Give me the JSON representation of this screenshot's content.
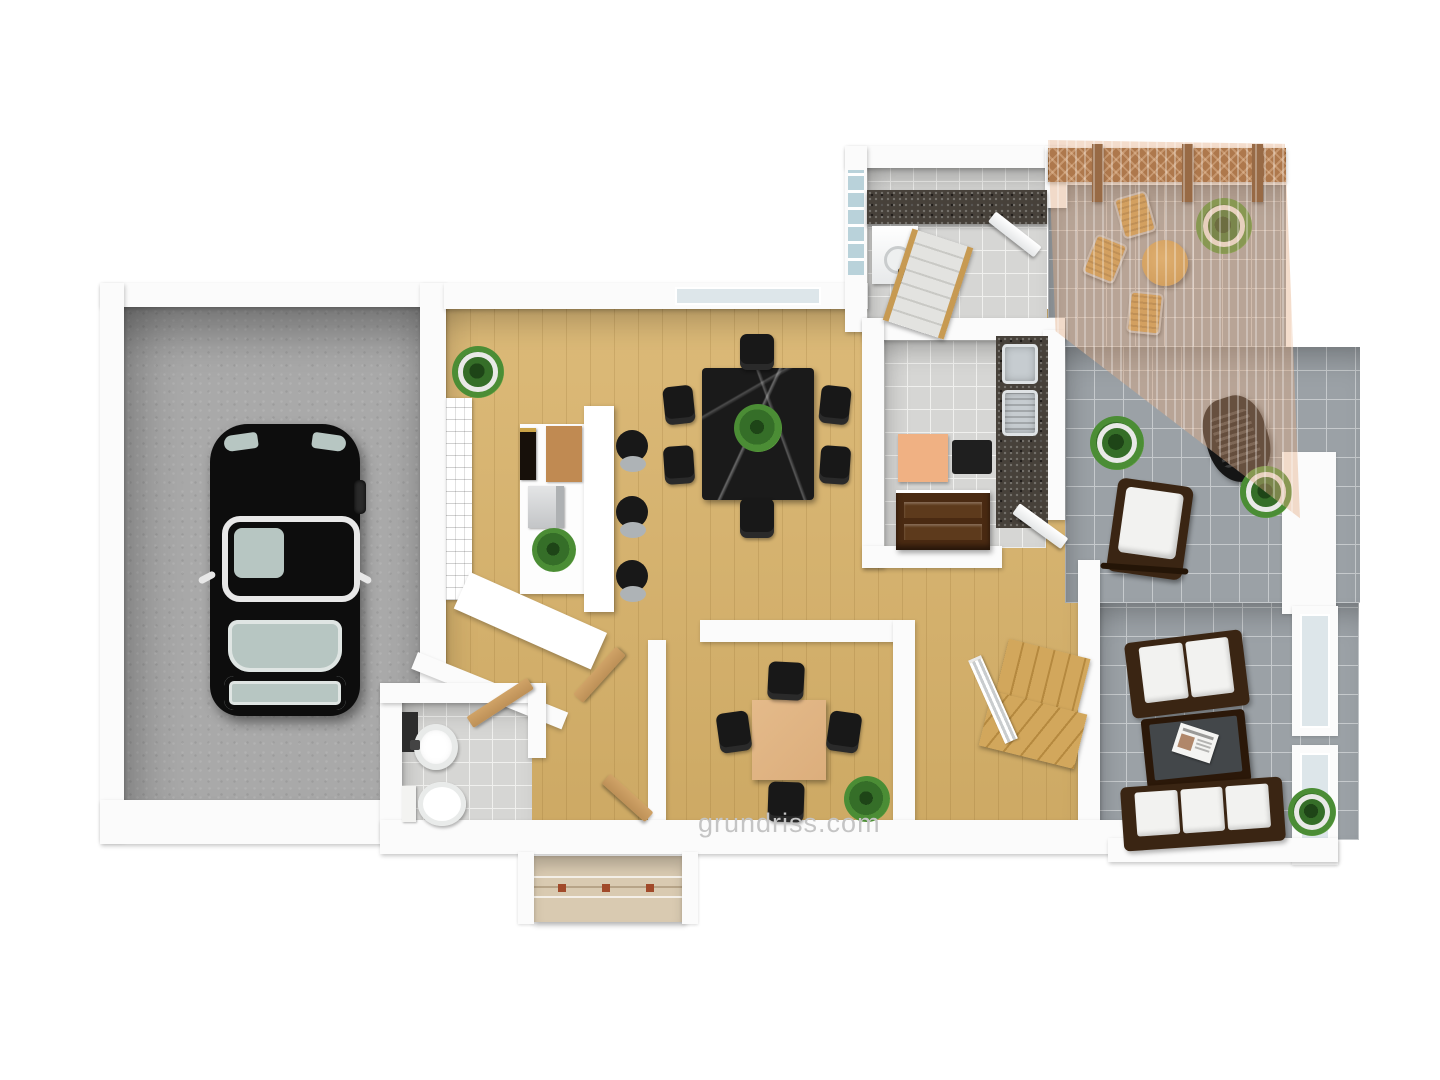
{
  "watermark": {
    "text": "grundriss.com"
  },
  "palette": {
    "bg": "#ffffff",
    "wall": "#fbfbfb",
    "garageFloor": "#a9a9a9",
    "woodFloor": "#d8b269",
    "tileTerrace": "#9ba1a6",
    "tileGrout": "#c6cacd",
    "tileLight": "#d6d6d4",
    "tileLightGrout": "#f0f0ee",
    "granite": "#47413a",
    "steel": "#c6ccd0",
    "carBody": "#0d0d0d",
    "carGlass": "#b7c6c2",
    "sofaFrame": "#3a2513",
    "cushion": "#f2f2f0",
    "coffeeTable": "#2b1809",
    "marble": "#1a1a1a",
    "chairBlack": "#181818",
    "officeTable": "#dcae7c",
    "plantGreen": "#356e28",
    "plantDark": "#1e4517",
    "pot": "#e9e9e7",
    "doorWood": "#bd9057",
    "trellis": "#8a572a",
    "trellisDark": "#66401e",
    "awning": "rgba(228,170,128,0.40)",
    "bistro": "#c99a4b",
    "stairWood": "#d2a75c",
    "stepStone": "#d9cab1",
    "glassPane": "#dde6ea",
    "glassBlock": "#b9d2da",
    "peach": "#f0b183",
    "sideboard": "#4a2a12",
    "watermark": "#c4c4c4"
  },
  "scene": {
    "type": "3d-floor-plan-render",
    "rooms": [
      "garage",
      "living-dining-room",
      "utility-room",
      "kitchen",
      "upper-terrace",
      "side-terrace",
      "lounge-conservatory",
      "study",
      "stair-room",
      "bathroom",
      "hallway",
      "entry"
    ],
    "furniture": [
      "black-car",
      "wine-rack",
      "bar-counter",
      "bar-stools",
      "coffee-machine",
      "dining-table-marble",
      "dining-chairs",
      "washing-machine",
      "laundry-counter",
      "basement-stairs",
      "trellis-fence",
      "sun-awning",
      "bistro-table",
      "bistro-chairs",
      "double-sink",
      "sideboard",
      "peach-cabinet",
      "rocking-chair",
      "bbq-grill",
      "sofa",
      "coffee-table-with-newspaper",
      "second-sofa",
      "square-wood-table",
      "study-chairs",
      "staircase",
      "toilet",
      "washbasin",
      "wooden-doors",
      "entry-steps",
      "potted-plants"
    ]
  }
}
